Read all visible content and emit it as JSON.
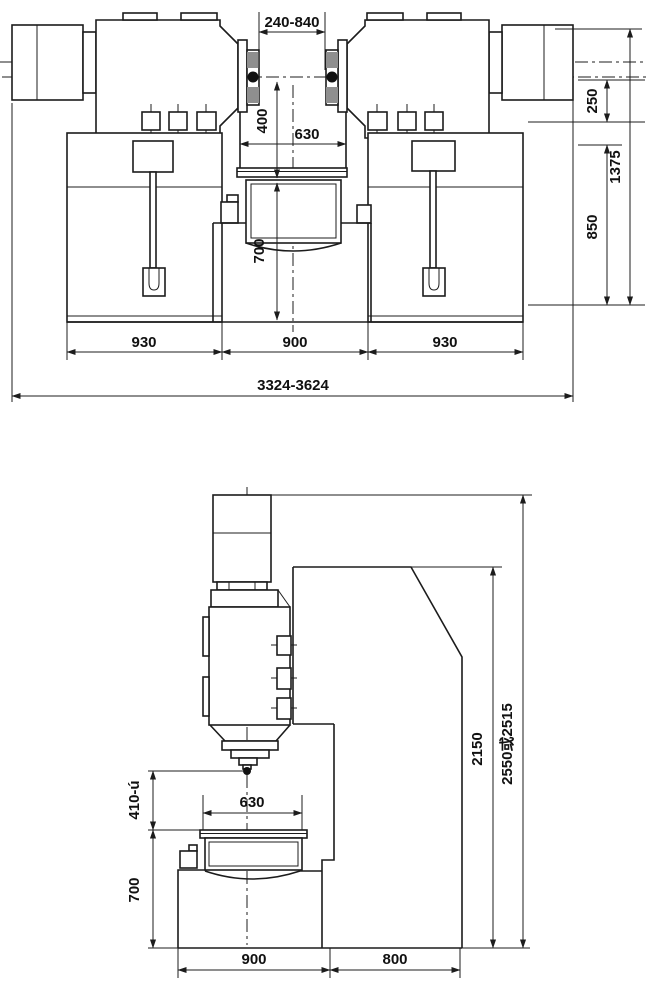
{
  "colors": {
    "line": "#1c1c1c",
    "background": "#ffffff",
    "shading": "#8f8f8f"
  },
  "views": {
    "front": {
      "dims": {
        "spindle_gap": "240-840",
        "center_to_table": "400",
        "table_width": "630",
        "table_to_floor": "700",
        "spindle_to_bed": "250",
        "overall_height": "1375",
        "bed_height": "850",
        "left_bed_width": "930",
        "center_width": "900",
        "right_bed_width": "930",
        "overall_width": "3324-3624"
      }
    },
    "side": {
      "dims": {
        "stroke_range": "410-ú",
        "table_width": "630",
        "table_to_floor": "700",
        "base_width": "900",
        "column_depth": "800",
        "column_height": "2150",
        "overall_height": "2550或2515"
      }
    }
  }
}
